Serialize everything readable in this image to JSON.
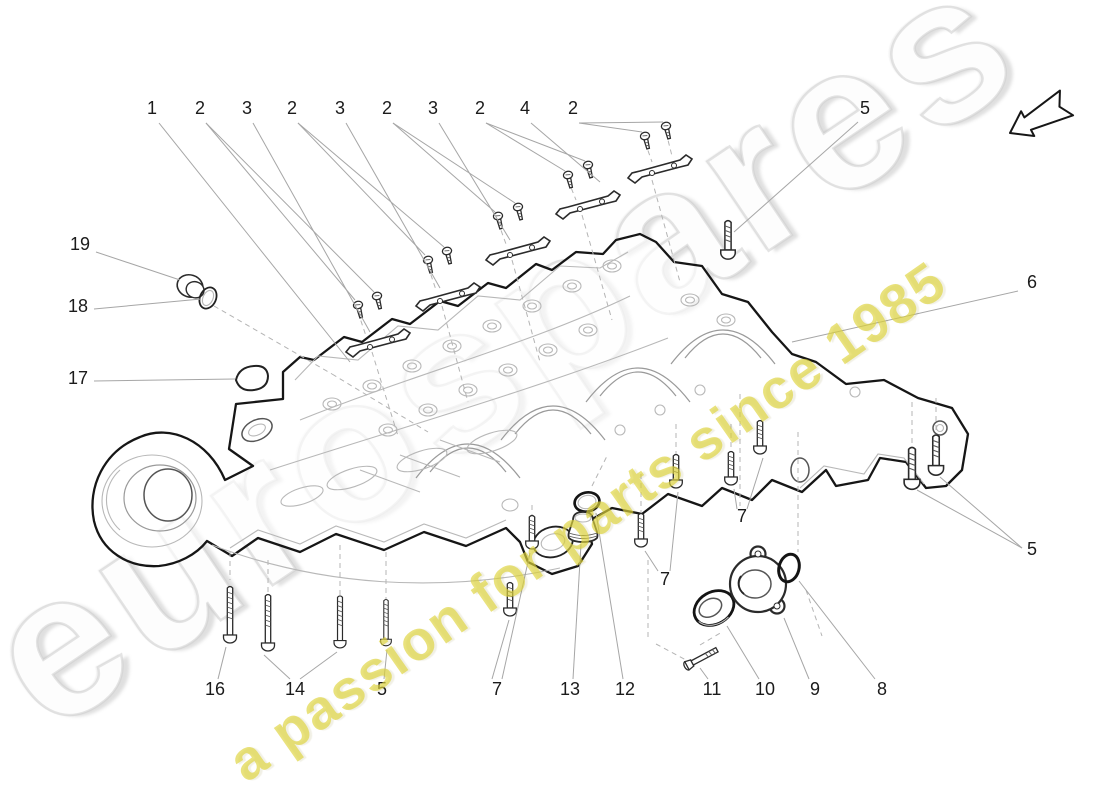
{
  "watermarks": {
    "brand": "eurospares",
    "tagline": "a passion for parts since 1985",
    "brand_color": "#d9d9d9",
    "tagline_color": "#ded43c"
  },
  "icons": {
    "direction_arrow": "direction-arrow-icon"
  },
  "diagram": {
    "type": "exploded-parts-diagram",
    "subject": "engine oil sump",
    "callouts": [
      {
        "label": "1",
        "x": 152,
        "y": 114,
        "leaders": [
          [
            159,
            123,
            350,
            362
          ]
        ]
      },
      {
        "label": "2",
        "x": 200,
        "y": 114,
        "leaders": [
          [
            206,
            123,
            355,
            300
          ],
          [
            206,
            123,
            374,
            292
          ]
        ]
      },
      {
        "label": "3",
        "x": 247,
        "y": 114,
        "leaders": [
          [
            253,
            123,
            370,
            332
          ]
        ]
      },
      {
        "label": "2",
        "x": 292,
        "y": 114,
        "leaders": [
          [
            298,
            123,
            425,
            255
          ],
          [
            298,
            123,
            444,
            247
          ]
        ]
      },
      {
        "label": "3",
        "x": 340,
        "y": 114,
        "leaders": [
          [
            346,
            123,
            440,
            288
          ]
        ]
      },
      {
        "label": "2",
        "x": 387,
        "y": 114,
        "leaders": [
          [
            393,
            123,
            495,
            212
          ],
          [
            393,
            123,
            515,
            203
          ]
        ]
      },
      {
        "label": "3",
        "x": 433,
        "y": 114,
        "leaders": [
          [
            439,
            123,
            510,
            240
          ]
        ]
      },
      {
        "label": "2",
        "x": 480,
        "y": 114,
        "leaders": [
          [
            486,
            123,
            565,
            171
          ],
          [
            486,
            123,
            585,
            161
          ]
        ]
      },
      {
        "label": "4",
        "x": 525,
        "y": 114,
        "leaders": [
          [
            531,
            123,
            600,
            182
          ]
        ]
      },
      {
        "label": "2",
        "x": 573,
        "y": 114,
        "leaders": [
          [
            579,
            123,
            642,
            132
          ],
          [
            579,
            123,
            663,
            122
          ]
        ]
      },
      {
        "label": "5",
        "x": 865,
        "y": 114,
        "leaders": [
          [
            858,
            122,
            734,
            232
          ]
        ]
      },
      {
        "label": "19",
        "x": 80,
        "y": 250,
        "leaders": [
          [
            96,
            252,
            180,
            280
          ]
        ]
      },
      {
        "label": "18",
        "x": 78,
        "y": 312,
        "leaders": [
          [
            94,
            309,
            201,
            299
          ]
        ]
      },
      {
        "label": "17",
        "x": 78,
        "y": 384,
        "leaders": [
          [
            94,
            381,
            235,
            379
          ]
        ]
      },
      {
        "label": "6",
        "x": 1032,
        "y": 288,
        "leaders": [
          [
            1018,
            291,
            792,
            342
          ]
        ]
      },
      {
        "label": "5",
        "x": 1032,
        "y": 555,
        "leaders": [
          [
            1022,
            548,
            917,
            490
          ],
          [
            1022,
            548,
            940,
            477
          ]
        ]
      },
      {
        "label": "7",
        "x": 742,
        "y": 522,
        "leaders": [
          [
            737,
            509,
            734,
            489
          ],
          [
            747,
            509,
            763,
            458
          ]
        ]
      },
      {
        "label": "7",
        "x": 665,
        "y": 585,
        "leaders": [
          [
            658,
            571,
            645,
            551
          ],
          [
            670,
            571,
            678,
            492
          ]
        ]
      },
      {
        "label": "7",
        "x": 497,
        "y": 695,
        "leaders": [
          [
            492,
            679,
            509,
            620
          ],
          [
            502,
            679,
            530,
            553
          ]
        ]
      },
      {
        "label": "16",
        "x": 215,
        "y": 695,
        "leaders": [
          [
            218,
            679,
            226,
            647
          ]
        ]
      },
      {
        "label": "14",
        "x": 295,
        "y": 695,
        "leaders": [
          [
            290,
            679,
            264,
            655
          ],
          [
            300,
            679,
            337,
            652
          ]
        ]
      },
      {
        "label": "5",
        "x": 382,
        "y": 695,
        "leaders": [
          [
            384,
            679,
            387,
            650
          ]
        ]
      },
      {
        "label": "13",
        "x": 570,
        "y": 695,
        "leaders": [
          [
            573,
            679,
            581,
            544
          ]
        ]
      },
      {
        "label": "12",
        "x": 625,
        "y": 695,
        "leaders": [
          [
            623,
            679,
            596,
            513
          ]
        ]
      },
      {
        "label": "11",
        "x": 712,
        "y": 695,
        "leaders": [
          [
            708,
            679,
            700,
            668
          ]
        ]
      },
      {
        "label": "10",
        "x": 765,
        "y": 695,
        "leaders": [
          [
            759,
            679,
            727,
            626
          ]
        ]
      },
      {
        "label": "9",
        "x": 815,
        "y": 695,
        "leaders": [
          [
            809,
            679,
            784,
            618
          ]
        ]
      },
      {
        "label": "8",
        "x": 882,
        "y": 695,
        "leaders": [
          [
            875,
            679,
            799,
            581
          ]
        ]
      }
    ],
    "dashed_guides": [
      [
        372,
        352,
        398,
        436
      ],
      [
        442,
        306,
        468,
        402
      ],
      [
        512,
        260,
        540,
        362
      ],
      [
        582,
        215,
        612,
        320
      ],
      [
        652,
        180,
        680,
        282
      ],
      [
        214,
        306,
        332,
        374
      ],
      [
        332,
        374,
        428,
        432
      ],
      [
        592,
        486,
        608,
        454
      ],
      [
        740,
        394,
        740,
        506
      ],
      [
        798,
        432,
        798,
        552
      ],
      [
        912,
        402,
        912,
        446
      ],
      [
        936,
        398,
        936,
        436
      ],
      [
        230,
        552,
        230,
        580
      ],
      [
        268,
        560,
        268,
        592
      ],
      [
        340,
        545,
        340,
        598
      ],
      [
        386,
        552,
        386,
        606
      ],
      [
        532,
        505,
        532,
        520
      ],
      [
        641,
        474,
        641,
        514
      ],
      [
        676,
        424,
        676,
        458
      ],
      [
        731,
        424,
        731,
        454
      ],
      [
        648,
        560,
        648,
        640
      ],
      [
        656,
        644,
        686,
        660
      ],
      [
        700,
        645,
        722,
        632
      ],
      [
        806,
        590,
        822,
        636
      ],
      [
        358,
        312,
        366,
        336
      ],
      [
        428,
        266,
        436,
        290
      ],
      [
        498,
        222,
        506,
        244
      ],
      [
        568,
        180,
        576,
        200
      ],
      [
        645,
        142,
        652,
        162
      ],
      [
        666,
        132,
        672,
        156
      ]
    ]
  }
}
